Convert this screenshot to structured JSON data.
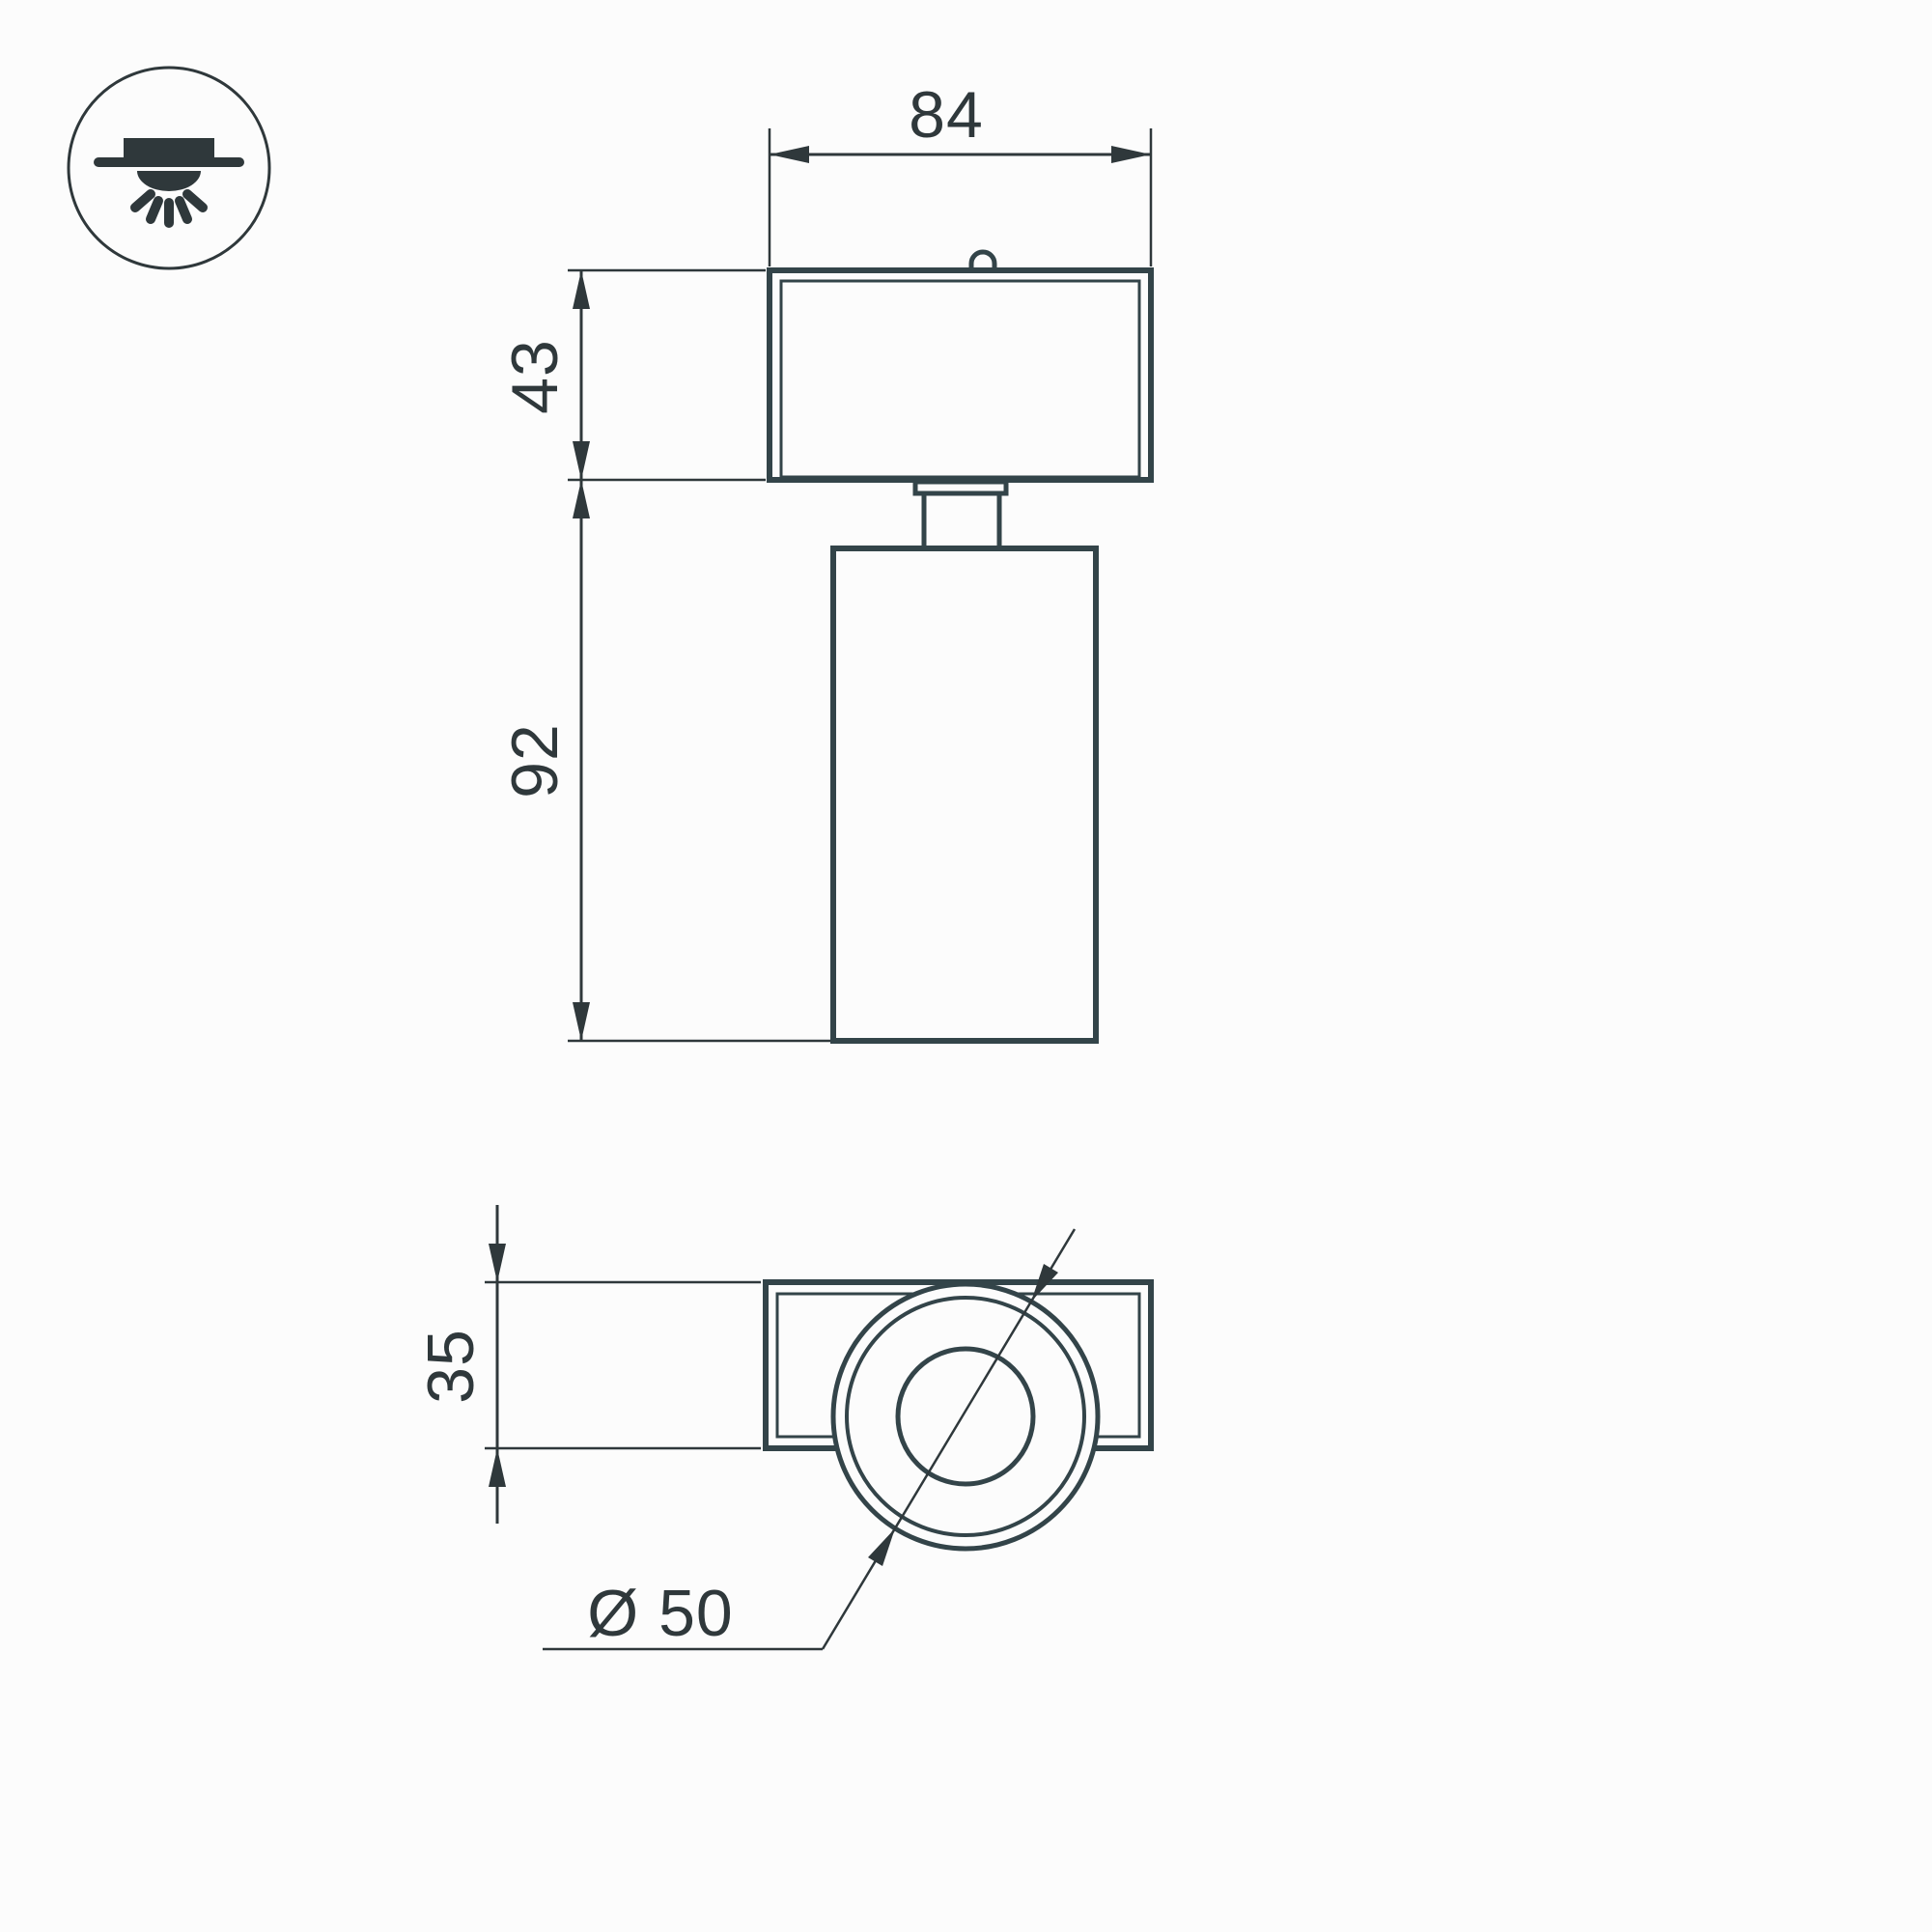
{
  "page": {
    "background": "#fcfcfc"
  },
  "drawing": {
    "kind": "luminaire-dimension-drawing",
    "ink": {
      "outline": "#334449",
      "dimension": "#2f383b"
    },
    "icon": {
      "name": "ceiling-mounted-light-icon"
    },
    "front_view": {
      "dims": {
        "width": "84",
        "head_height": "43",
        "body_height": "92"
      }
    },
    "top_view": {
      "dims": {
        "depth": "35",
        "diameter": "Ø 50"
      }
    }
  }
}
